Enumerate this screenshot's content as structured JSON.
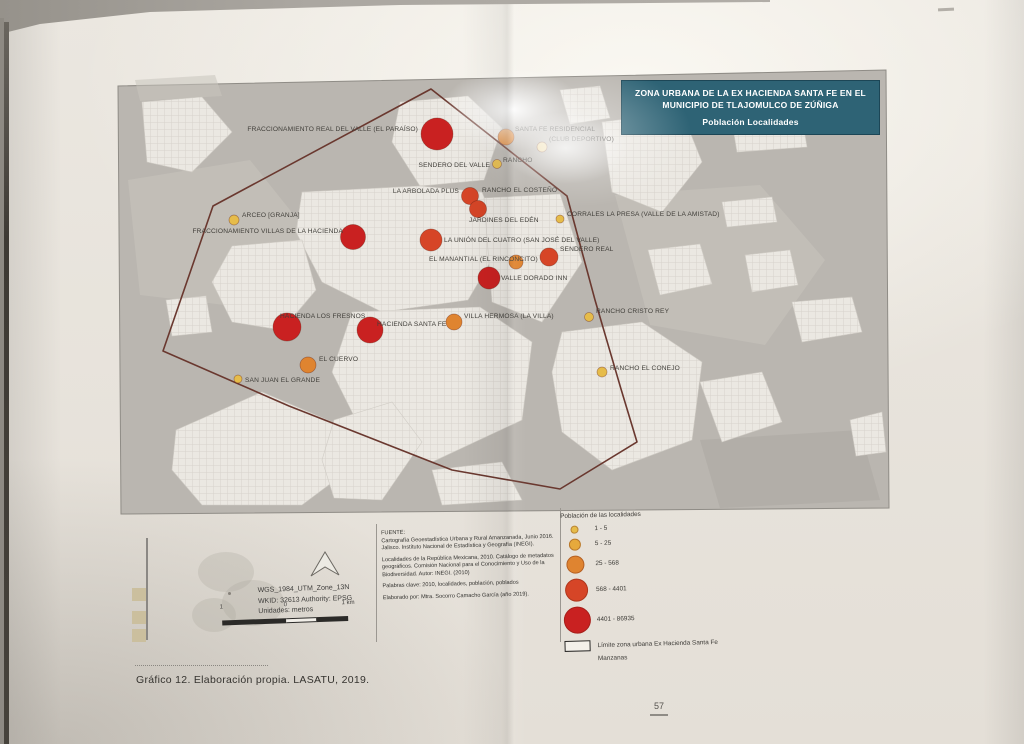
{
  "document": {
    "caption": "Gráfico 12. Elaboración propia. LASATU, 2019.",
    "page_number": "57"
  },
  "map": {
    "title": "ZONA URBANA DE LA EX HACIENDA SANTA FE EN EL MUNICIPIO DE TLAJOMULCO DE ZÚÑIGA",
    "subtitle": "Población Localidades",
    "boundary": [
      [
        431,
        89
      ],
      [
        213,
        206
      ],
      [
        163,
        351
      ],
      [
        289,
        406
      ],
      [
        452,
        470
      ],
      [
        560,
        489
      ],
      [
        637,
        442
      ],
      [
        621,
        389
      ],
      [
        595,
        300
      ],
      [
        567,
        196
      ]
    ],
    "localities": [
      {
        "name": "FRACCIONAMIENTO REAL DEL VALLE (EL PARAÍSO)",
        "x": 437,
        "y": 134,
        "r": 16,
        "color": "#c92121",
        "lx": 418,
        "ly": 131,
        "anchor": "end"
      },
      {
        "name": "SANTA FE RESIDENCIAL",
        "x": 506,
        "y": 137,
        "r": 8,
        "color": "#df8430",
        "lx": 515,
        "ly": 131,
        "anchor": "start"
      },
      {
        "name": "(CLUB DEPORTIVO)",
        "x": 542,
        "y": 147,
        "r": 5,
        "color": "#eed9a2",
        "lx": 549,
        "ly": 141,
        "anchor": "start"
      },
      {
        "name": "SENDERO DEL VALLE",
        "x": 497,
        "y": 164,
        "r": 4.5,
        "color": "#e6bc4a",
        "lx": 490,
        "ly": 167,
        "anchor": "end"
      },
      {
        "name": "RANCHO",
        "lx": 503,
        "ly": 162,
        "anchor": "start"
      },
      {
        "name": "LA ARBOLADA PLUS",
        "x": 470,
        "y": 196,
        "r": 8.5,
        "color": "#d64527",
        "lx": 459,
        "ly": 193,
        "anchor": "end"
      },
      {
        "name": "RANCHO EL COSTEÑO",
        "lx": 482,
        "ly": 192,
        "anchor": "start"
      },
      {
        "name": "ARCEO [GRANJA]",
        "x": 234,
        "y": 220,
        "r": 5,
        "color": "#e6bc4a",
        "lx": 242,
        "ly": 217,
        "anchor": "start"
      },
      {
        "name": "FRACCIONAMIENTO VILLAS DE LA HACIENDA",
        "x": 353,
        "y": 237,
        "r": 12.5,
        "color": "#c92121",
        "lx": 343,
        "ly": 233,
        "anchor": "end"
      },
      {
        "name": "JARDINES DEL EDÉN",
        "x": 478,
        "y": 209,
        "r": 8.5,
        "color": "#d64527",
        "lx": 469,
        "ly": 222,
        "anchor": "start"
      },
      {
        "name": "CORRALES LA PRESA (VALLE DE LA AMISTAD)",
        "x": 560,
        "y": 219,
        "r": 4,
        "color": "#e6bc4a",
        "lx": 567,
        "ly": 216,
        "anchor": "start"
      },
      {
        "name": "LA UNIÓN DEL CUATRO (SAN JOSÉ DEL VALLE)",
        "x": 431,
        "y": 240,
        "r": 11,
        "color": "#d64527",
        "lx": 444,
        "ly": 242,
        "anchor": "start"
      },
      {
        "name": "EL MANANTIAL (EL RINCONCITO)",
        "x": 516,
        "y": 262,
        "r": 7,
        "color": "#df8430",
        "lx": 429,
        "ly": 261,
        "anchor": "start"
      },
      {
        "name": "SENDERO REAL",
        "x": 549,
        "y": 257,
        "r": 9,
        "color": "#d64527",
        "lx": 560,
        "ly": 251,
        "anchor": "start"
      },
      {
        "name": "VALLE DORADO INN",
        "x": 489,
        "y": 278,
        "r": 11,
        "color": "#c92121",
        "lx": 501,
        "ly": 280,
        "anchor": "start"
      },
      {
        "name": "HACIENDA LOS FRESNOS",
        "x": 287,
        "y": 327,
        "r": 14,
        "color": "#c92121",
        "lx": 280,
        "ly": 318,
        "anchor": "start"
      },
      {
        "name": "HACIENDA SANTA FE",
        "x": 370,
        "y": 330,
        "r": 13,
        "color": "#c92121",
        "lx": 377,
        "ly": 326,
        "anchor": "start"
      },
      {
        "name": "VILLA HERMOSA (LA VILLA)",
        "x": 454,
        "y": 322,
        "r": 8,
        "color": "#df8430",
        "lx": 464,
        "ly": 318,
        "anchor": "start"
      },
      {
        "name": "RANCHO CRISTO REY",
        "x": 589,
        "y": 317,
        "r": 4.5,
        "color": "#e6bc4a",
        "lx": 596,
        "ly": 313,
        "anchor": "start"
      },
      {
        "name": "EL CUERVO",
        "x": 308,
        "y": 365,
        "r": 8,
        "color": "#df8430",
        "lx": 319,
        "ly": 361,
        "anchor": "start"
      },
      {
        "name": "SAN JUAN EL GRANDE",
        "x": 238,
        "y": 379,
        "r": 4,
        "color": "#e6bc4a",
        "lx": 245,
        "ly": 382,
        "anchor": "start"
      },
      {
        "name": "RANCHO EL CONEJO",
        "x": 602,
        "y": 372,
        "r": 5,
        "color": "#e6bc4a",
        "lx": 610,
        "ly": 370,
        "anchor": "start"
      }
    ]
  },
  "legend": {
    "title": "Población de las localidades",
    "classes": [
      {
        "label": "1 - 5",
        "color": "#e6bc4a",
        "r": 4
      },
      {
        "label": "5 - 25",
        "color": "#e6a93c",
        "r": 6
      },
      {
        "label": "25 - 568",
        "color": "#df8430",
        "r": 9
      },
      {
        "label": "568 - 4401",
        "color": "#d64527",
        "r": 11.5
      },
      {
        "label": "4401 - 86935",
        "color": "#c92121",
        "r": 13.5
      }
    ],
    "boundary_item": "Límite zona urbana Ex Hacienda Santa Fe",
    "blocks_item": "Manzanas"
  },
  "source": {
    "heading": "FUENTE:",
    "paragraphs": [
      "Cartografía Geoestadística Urbana y Rural Amanzanada, Junio 2016. Jalisco. Instituto Nacional de Estadística y Geografía (INEGI).",
      "Localidades de la República Mexicana, 2010. Catálogo de metadatos geográficos. Comisión Nacional para el Conocimiento y Uso de la Biodiversidad. Autor: INEGI. (2010)",
      "Palabras clave: 2010, localidades, población, poblados",
      "Elaborado por: Mtra. Socorro Camacho García (año 2019)."
    ]
  },
  "projection": {
    "line1": "WGS_1984_UTM_Zone_13N",
    "line2": "WKID: 32613 Authority: EPSG",
    "line3": "Unidades: metros"
  },
  "scalebar": {
    "left": "1",
    "middle": "0",
    "right": "1 km"
  },
  "colors": {
    "title_box": "#2e6375",
    "map_background": "#bab6b0",
    "boundary_line": "#6a382f"
  }
}
